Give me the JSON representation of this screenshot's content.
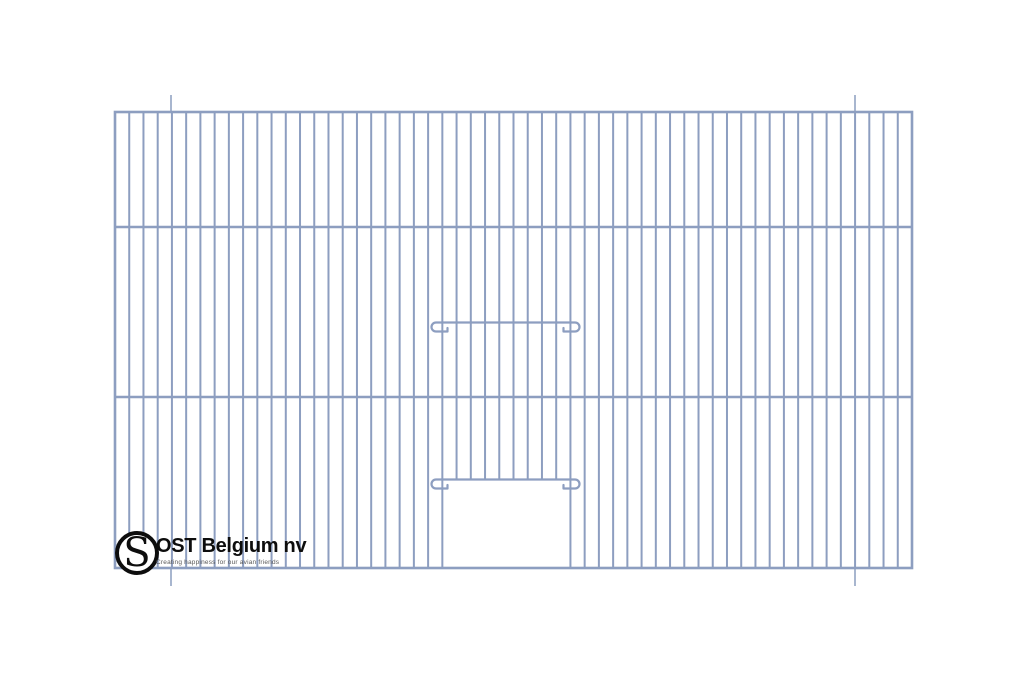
{
  "meta": {
    "background": "#ffffff",
    "subject": "wire cage front panel technical drawing"
  },
  "logo": {
    "monogram": "S",
    "name": "OST Belgium nv",
    "tagline": "Creating happiness for our avian friends",
    "ring_color": "#0d0d0d",
    "name_color": "#0d0d0d",
    "tagline_color": "#595959"
  },
  "drawing": {
    "type": "cage-front-panel",
    "colors": {
      "wire": "#8d9ec0",
      "extension": "#a8b6cf"
    },
    "panel": {
      "x1": 115,
      "y1": 112,
      "x2": 912,
      "y2": 568
    },
    "horizontal_bars_y": [
      227,
      397
    ],
    "wire_count": 57,
    "door": {
      "opening": {
        "x1": 444,
        "x2": 567,
        "top_y": 479.5
      },
      "hook_bars": [
        {
          "y": 322.5,
          "x1": 431.5,
          "x2": 579.5
        },
        {
          "y": 470.5,
          "x1": 431.5,
          "x2": 579.5,
          "note": "unused placeholder"
        }
      ],
      "hook_bar_ys": [
        322.5,
        470.5
      ]
    },
    "hook_bars": [
      {
        "y": 322.5,
        "x1": 431.5,
        "x2": 579.5
      },
      {
        "y": 479.5,
        "x1": 431.5,
        "x2": 579.5
      }
    ],
    "extension_lines": {
      "x": [
        171,
        855
      ],
      "top": [
        95,
        113
      ],
      "bottom": [
        567,
        586
      ]
    }
  }
}
